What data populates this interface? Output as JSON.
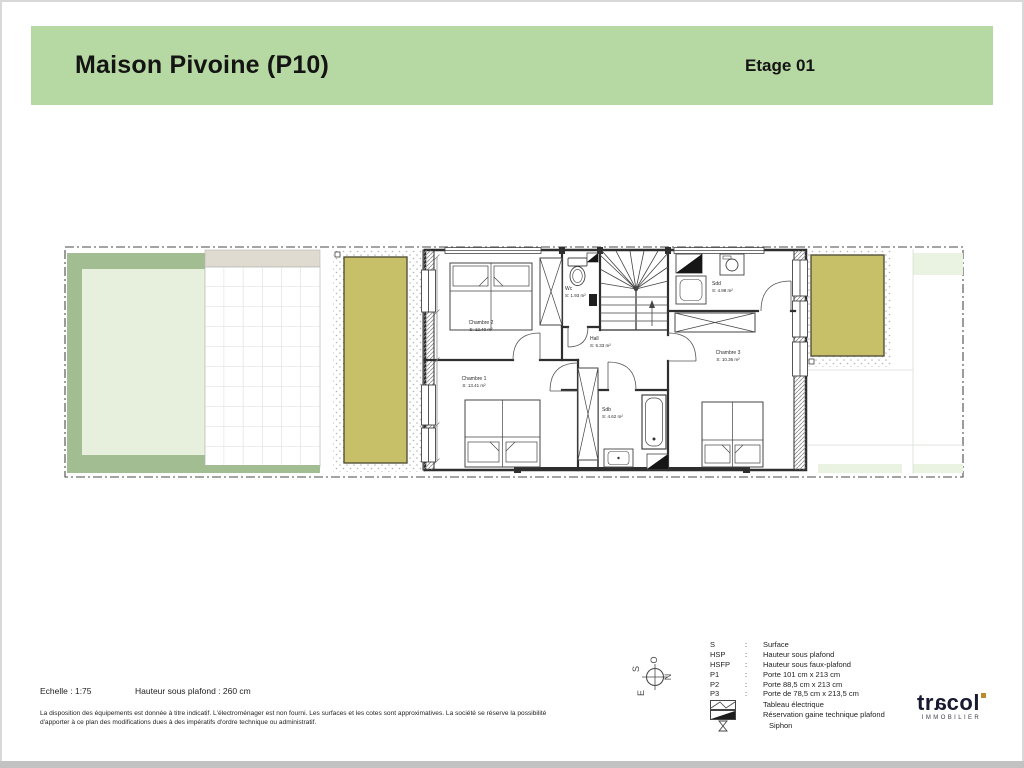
{
  "header": {
    "title": "Maison Pivoine (P10)",
    "floor": "Etage 01",
    "bg_color": "#b6d8a2"
  },
  "plan": {
    "rooms": [
      {
        "id": "chambre2",
        "name": "Chambre 2",
        "surface": "S: 12.40 m²"
      },
      {
        "id": "chambre1",
        "name": "Chambre 1",
        "surface": "S: 13.41 m²"
      },
      {
        "id": "chambre3",
        "name": "Chambre 3",
        "surface": "S: 10.36 m²"
      },
      {
        "id": "wc",
        "name": "Wc",
        "surface": "S: 1.93 m²"
      },
      {
        "id": "hall",
        "name": "Hall",
        "surface": "S: 5.33 m²"
      },
      {
        "id": "sdd",
        "name": "Sdd",
        "surface": "S: 4.98 m²"
      },
      {
        "id": "sdb",
        "name": "Sdb",
        "surface": "S: 4.62 m²"
      }
    ],
    "colors": {
      "terrace": "#c7c068",
      "hedge": "#a3bd93",
      "lawn": "#e6f0dc",
      "paving_band": "#dfdbd1",
      "wall": "#2e2e2e"
    }
  },
  "compass": {
    "n": "N",
    "s": "S",
    "e": "E",
    "o": "O"
  },
  "legend": {
    "items": [
      {
        "key": "S",
        "value": "Surface"
      },
      {
        "key": "HSP",
        "value": "Hauteur sous plafond"
      },
      {
        "key": "HSFP",
        "value": "Hauteur sous faux-plafond"
      },
      {
        "key": "P1",
        "value": "Porte 101 cm x 213 cm"
      },
      {
        "key": "P2",
        "value": "Porte 88,5 cm x 213 cm"
      },
      {
        "key": "P3",
        "value": "Porte de 78,5 cm x 213,5 cm"
      }
    ],
    "symbols": [
      {
        "icon": "electrical-panel",
        "value": "Tableau électrique"
      },
      {
        "icon": "ceiling-duct",
        "value": "Réservation gaine technique plafond"
      },
      {
        "icon": "siphon",
        "value": "Siphon"
      }
    ]
  },
  "footer": {
    "scale": "Echelle : 1:75",
    "ceiling": "Hauteur sous plafond : 260 cm",
    "disclaimer": "La disposition des équipements est donnée à titre indicatif. L'électroménager est non fourni. Les surfaces et les cotes sont approximatives. La société se réserve la possibilité d'apporter à ce plan des modifications dues à des impératifs d'ordre technique ou administratif."
  },
  "logo": {
    "t1": "tr",
    "a": "a",
    "t2": "col",
    "sub": "IMMOBILIER",
    "accent": "#b98a2e"
  }
}
